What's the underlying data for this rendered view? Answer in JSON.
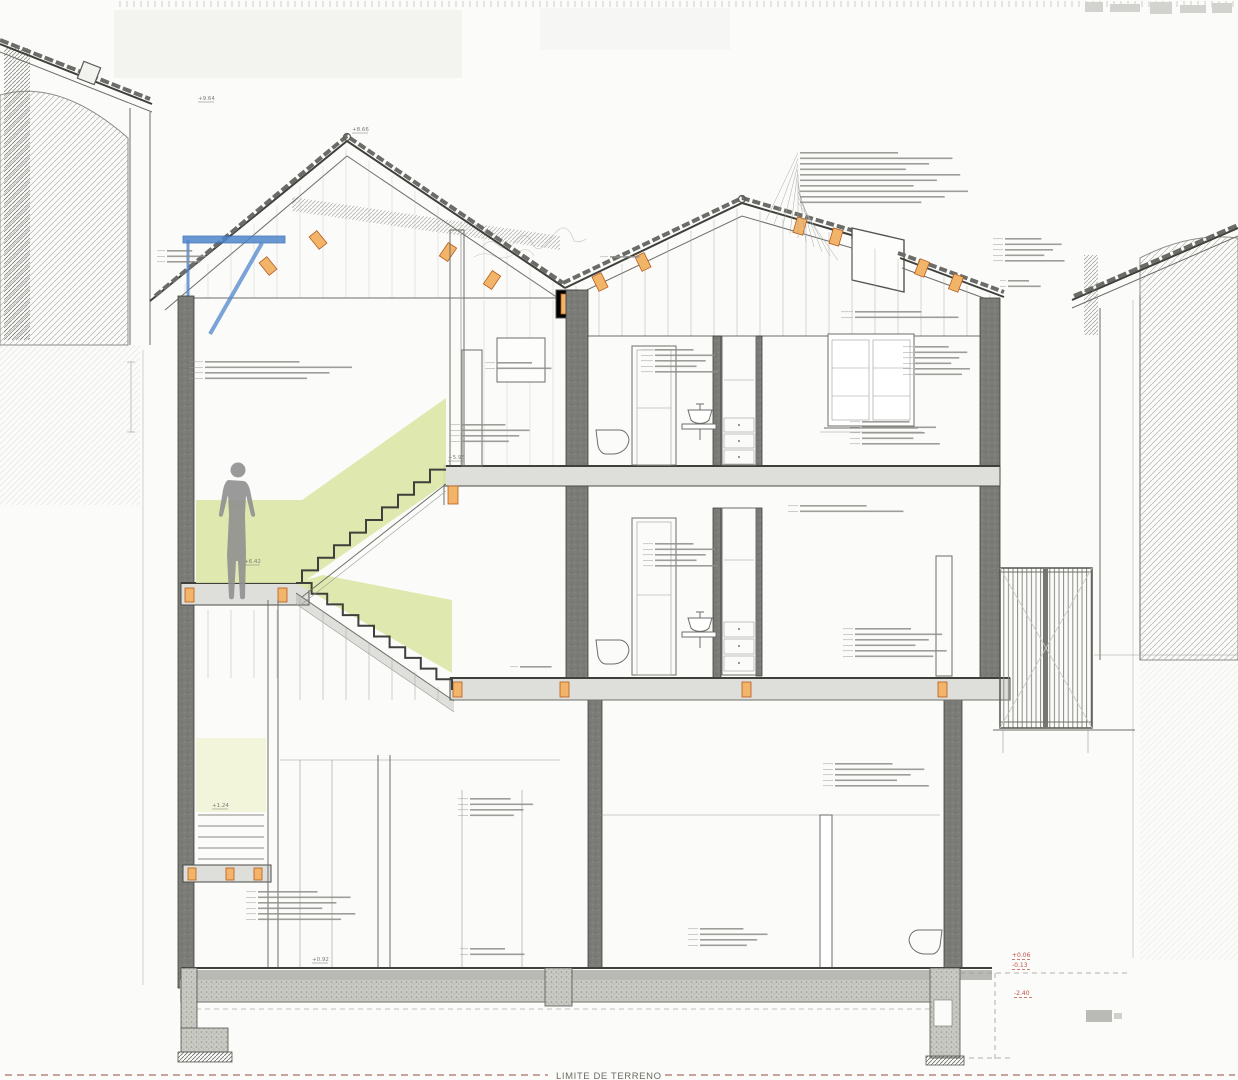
{
  "drawing": {
    "terrain_label": "LIMITE DE TERRENO",
    "colors": {
      "stair_highlight": "#dbe7a6",
      "shaft_highlight": "#f3f5da",
      "wood_accent": "#f2b469",
      "steel_blue": "#4f86cc",
      "level_red": "#c25048",
      "wall_poche": "#7b7b77"
    },
    "levels_black": [
      {
        "value": "+9.64",
        "x": 198,
        "y": 100
      },
      {
        "value": "+8.66",
        "x": 352,
        "y": 131
      },
      {
        "value": "+6.42",
        "x": 244,
        "y": 563
      },
      {
        "value": "+5.96",
        "x": 448,
        "y": 459
      },
      {
        "value": "+1.24",
        "x": 212,
        "y": 807
      },
      {
        "value": "+0.92",
        "x": 312,
        "y": 961
      }
    ],
    "levels_red": [
      {
        "value": "+0.06",
        "x": 1012,
        "y": 957
      },
      {
        "value": "-0.13",
        "x": 1012,
        "y": 967
      },
      {
        "value": "-2.40",
        "x": 1014,
        "y": 995
      }
    ],
    "annotation_clusters": [
      {
        "x": 800,
        "y": 152,
        "n": 10,
        "w": 140,
        "fan": [
          766,
          220,
          8,
          4.5
        ]
      },
      {
        "x": 1005,
        "y": 238,
        "n": 5,
        "w": 52,
        "lead": 10
      },
      {
        "x": 1008,
        "y": 280,
        "n": 2,
        "w": 30,
        "lead": 6
      },
      {
        "x": 205,
        "y": 361,
        "n": 4,
        "w": 135,
        "lead": 14
      },
      {
        "x": 167,
        "y": 250,
        "n": 3,
        "w": 36,
        "lead": 8
      },
      {
        "x": 497,
        "y": 362,
        "n": 2,
        "w": 50,
        "lead": 10
      },
      {
        "x": 462,
        "y": 424,
        "n": 4,
        "w": 62,
        "lead": 10
      },
      {
        "x": 655,
        "y": 349,
        "n": 5,
        "w": 55,
        "lead": 12
      },
      {
        "x": 915,
        "y": 346,
        "n": 6,
        "w": 48,
        "lead": 10
      },
      {
        "x": 855,
        "y": 311,
        "n": 2,
        "w": 95,
        "lead": 12
      },
      {
        "x": 862,
        "y": 421,
        "n": 5,
        "w": 68,
        "lead": 10
      },
      {
        "x": 800,
        "y": 505,
        "n": 2,
        "w": 95,
        "lead": 10
      },
      {
        "x": 855,
        "y": 628,
        "n": 6,
        "w": 80,
        "lead": 10
      },
      {
        "x": 655,
        "y": 543,
        "n": 5,
        "w": 55,
        "lead": 10
      },
      {
        "x": 610,
        "y": 256,
        "n": 1,
        "w": 42,
        "lead": 8
      },
      {
        "x": 520,
        "y": 666,
        "n": 1,
        "w": 45,
        "lead": 8
      },
      {
        "x": 470,
        "y": 798,
        "n": 4,
        "w": 58,
        "lead": 10
      },
      {
        "x": 258,
        "y": 891,
        "n": 6,
        "w": 85,
        "lead": 10
      },
      {
        "x": 700,
        "y": 928,
        "n": 4,
        "w": 62,
        "lead": 10
      },
      {
        "x": 835,
        "y": 763,
        "n": 5,
        "w": 82,
        "lead": 10
      },
      {
        "x": 470,
        "y": 948,
        "n": 2,
        "w": 50,
        "lead": 8
      }
    ]
  }
}
